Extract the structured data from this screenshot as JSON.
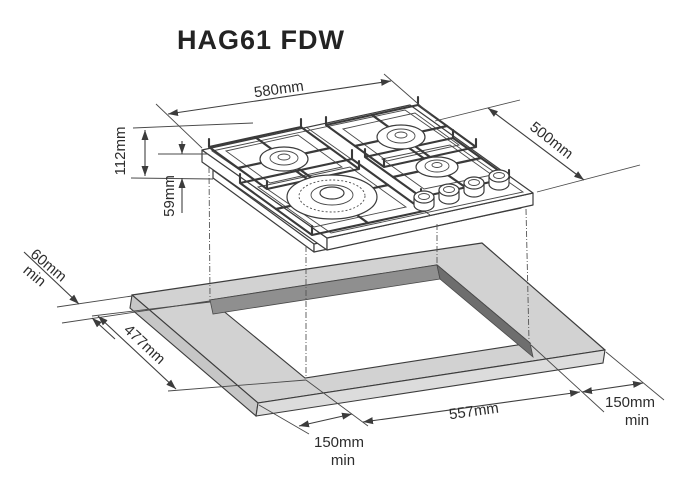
{
  "title": "HAG61 FDW",
  "diagram_type": "gas-hob-installation-dimensions",
  "colors": {
    "line": "#3c3c3c",
    "text": "#2d2d2d",
    "worktop_top": "#d2d2d2",
    "worktop_side_left": "#c6c6c6",
    "worktop_side_right": "#dcdcdc",
    "cutout_wall_nw": "#8f8f8f",
    "cutout_wall_ne": "#6e6e6e"
  },
  "labels": {
    "hob_width": "580mm",
    "hob_depth": "500mm",
    "height_total": "112mm",
    "height_below_worktop": "59mm",
    "clearance_left": {
      "value": "60mm",
      "qualifier": "min"
    },
    "cutout_depth": "477mm",
    "cutout_width": "557mm",
    "clearance_front": {
      "value": "150mm",
      "qualifier": "min"
    },
    "clearance_right": {
      "value": "150mm",
      "qualifier": "min"
    }
  }
}
